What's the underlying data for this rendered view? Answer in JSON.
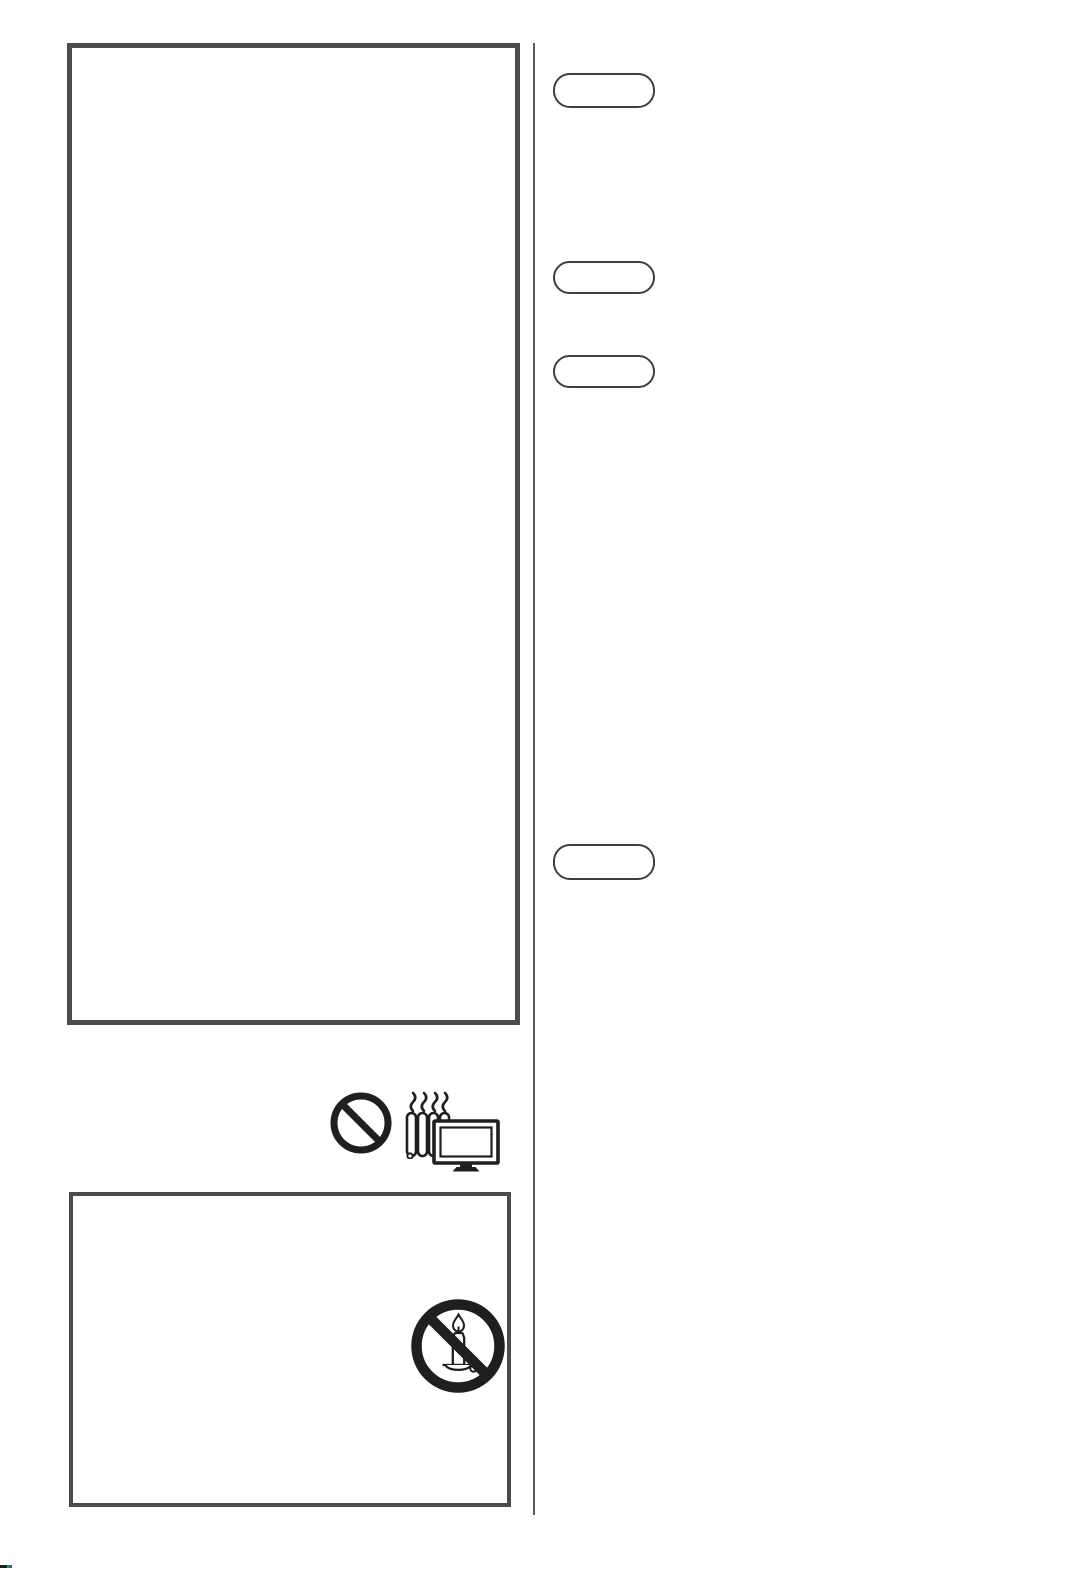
{
  "colors": {
    "page_bg": "#ffffff",
    "box_border": "#4b4b4b",
    "divider": "#5a5a5a",
    "pill_border": "#3f3f3f",
    "icon_ink": "#1f1f1f",
    "artifact_black": "#1e1e1e",
    "artifact_green": "#3a9e3c",
    "artifact_blue": "#3056c8"
  },
  "content": {
    "top_box": {
      "label": ""
    },
    "bottom_box": {
      "label": ""
    },
    "right_column": {
      "pills": [
        {
          "label": ""
        },
        {
          "label": ""
        },
        {
          "label": ""
        },
        {
          "label": ""
        }
      ]
    },
    "icons": {
      "prohibition": "prohibition-icon",
      "radiator": "radiator-heat-icon",
      "tv": "tv-icon",
      "no_candle": "no-open-flame-icon"
    }
  }
}
